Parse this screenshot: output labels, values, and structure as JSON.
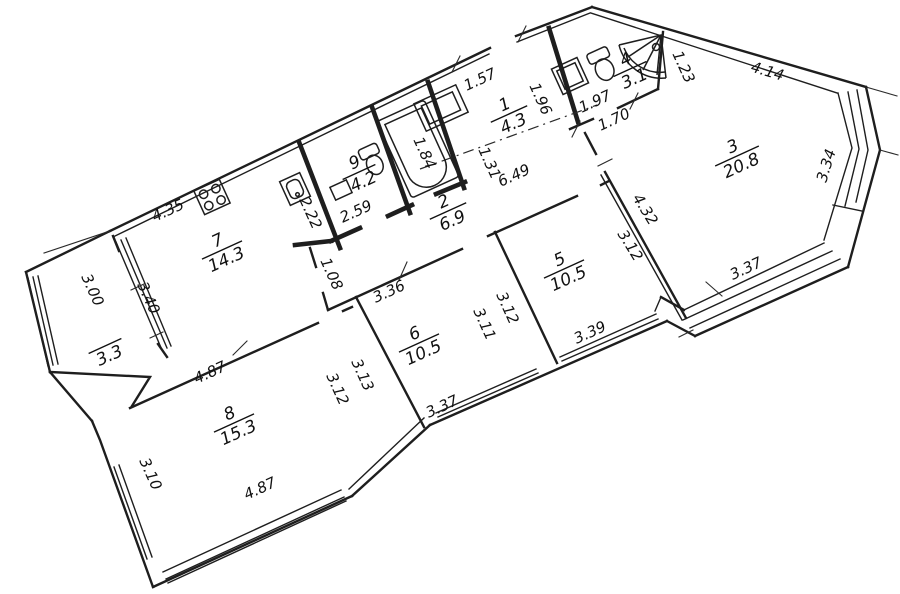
{
  "drawing": {
    "kind": "apartment floor plan",
    "line_color": "#1e1e1e",
    "background": "#ffffff"
  },
  "rooms": [
    {
      "number": "1",
      "area": "4.3"
    },
    {
      "number": "2",
      "area": "6.9"
    },
    {
      "number": "3",
      "area": "20.8"
    },
    {
      "number": "4",
      "area": "3.1"
    },
    {
      "number": "5",
      "area": "10.5"
    },
    {
      "number": "6",
      "area": "10.5"
    },
    {
      "number": "7",
      "area": "14.3"
    },
    {
      "number": "8",
      "area": "15.3"
    },
    {
      "number": "9",
      "area": "4.2"
    },
    {
      "number": "",
      "area": "3.3"
    }
  ],
  "dims": [
    "4.35",
    "1.57",
    "1.96",
    "1.97",
    "1.70",
    "1.23",
    "4.14",
    "3.34",
    "3.37",
    "4.32",
    "3.12",
    "3.39",
    "3.12",
    "3.11",
    "3.36",
    "3.13",
    "3.12",
    "3.37",
    "4.87",
    "3.10",
    "4.87",
    "3.00",
    "3.40",
    "2.22",
    "2.59",
    "1.08",
    "1.84",
    "1.31",
    "6.49"
  ]
}
